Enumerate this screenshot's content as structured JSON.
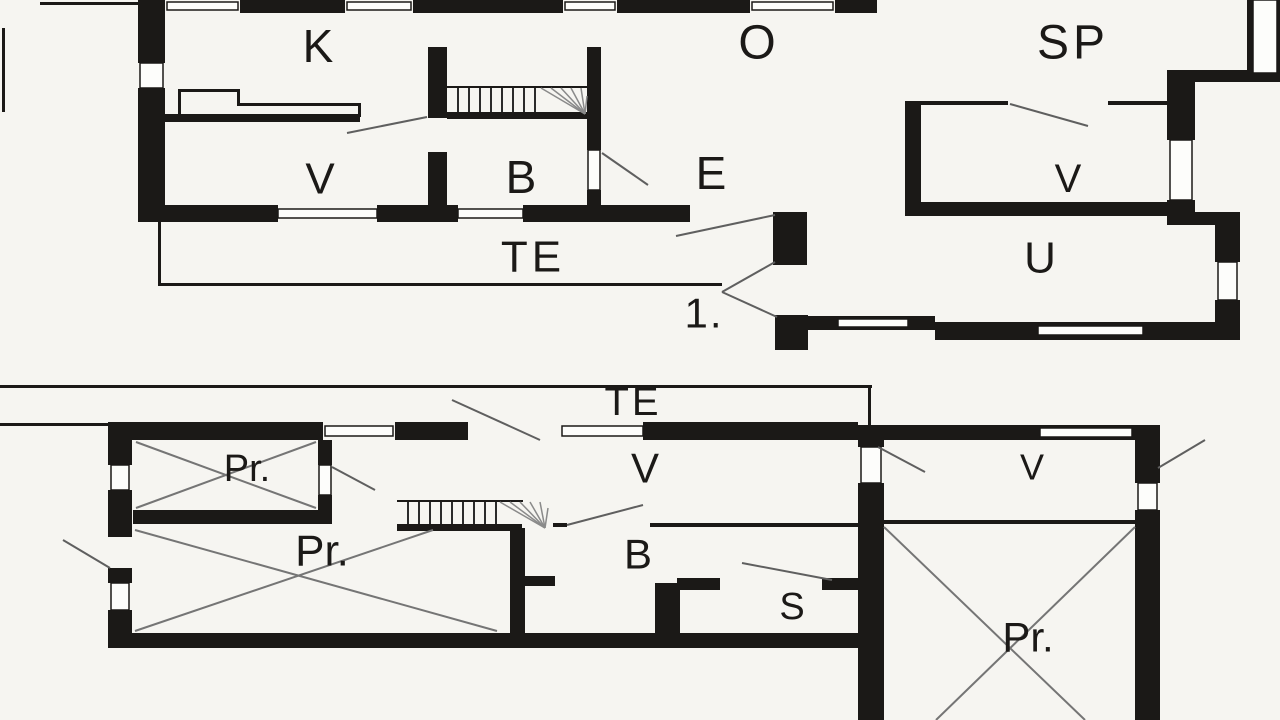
{
  "title": "House floor plans",
  "colors": {
    "background": "#f6f5f1",
    "ink": "#1b1917",
    "door_line": "#5f5f5f",
    "cross_line": "#757575",
    "stair_tread": "#2b2b2b",
    "stair_fan": "#8a8a8a",
    "window_fill": "#fdfdfb"
  },
  "floors": [
    {
      "id": "first-floor",
      "floor_label": "1."
    },
    {
      "id": "ground-floor",
      "floor_label": ""
    }
  ],
  "room_labels": [
    {
      "floor": "first",
      "text": "K",
      "x": 318,
      "y": 46,
      "size": 46,
      "spacing": 0
    },
    {
      "floor": "first",
      "text": "O",
      "x": 757,
      "y": 43,
      "size": 48,
      "spacing": 0
    },
    {
      "floor": "first",
      "text": "SP",
      "x": 1073,
      "y": 43,
      "size": 48,
      "spacing": 4
    },
    {
      "floor": "first",
      "text": "V",
      "x": 320,
      "y": 179,
      "size": 44,
      "spacing": 0
    },
    {
      "floor": "first",
      "text": "B",
      "x": 521,
      "y": 177,
      "size": 46,
      "spacing": 0
    },
    {
      "floor": "first",
      "text": "E",
      "x": 711,
      "y": 173,
      "size": 46,
      "spacing": 0
    },
    {
      "floor": "first",
      "text": "V",
      "x": 1068,
      "y": 179,
      "size": 40,
      "spacing": 0
    },
    {
      "floor": "first",
      "text": "TE",
      "x": 533,
      "y": 257,
      "size": 44,
      "spacing": 4
    },
    {
      "floor": "first",
      "text": "U",
      "x": 1040,
      "y": 258,
      "size": 44,
      "spacing": 0
    },
    {
      "floor": "first",
      "text": "1.",
      "x": 704,
      "y": 313,
      "size": 42,
      "spacing": 2
    },
    {
      "floor": "ground",
      "text": "TE",
      "x": 633,
      "y": 402,
      "size": 40,
      "spacing": 3
    },
    {
      "floor": "ground",
      "text": "Pr.",
      "x": 247,
      "y": 469,
      "size": 38,
      "spacing": 0
    },
    {
      "floor": "ground",
      "text": "V",
      "x": 645,
      "y": 468,
      "size": 42,
      "spacing": 0
    },
    {
      "floor": "ground",
      "text": "V",
      "x": 1032,
      "y": 467,
      "size": 36,
      "spacing": 0
    },
    {
      "floor": "ground",
      "text": "Pr.",
      "x": 322,
      "y": 551,
      "size": 44,
      "spacing": 0
    },
    {
      "floor": "ground",
      "text": "B",
      "x": 638,
      "y": 554,
      "size": 42,
      "spacing": 0
    },
    {
      "floor": "ground",
      "text": "S",
      "x": 792,
      "y": 607,
      "size": 38,
      "spacing": 0
    },
    {
      "floor": "ground",
      "text": "Pr.",
      "x": 1028,
      "y": 637,
      "size": 42,
      "spacing": 0
    }
  ],
  "geometry": {
    "walls": [
      [
        240,
        0,
        105,
        13
      ],
      [
        413,
        0,
        150,
        13
      ],
      [
        617,
        0,
        133,
        13
      ],
      [
        835,
        0,
        42,
        13
      ],
      [
        138,
        0,
        27,
        63
      ],
      [
        138,
        88,
        27,
        132
      ],
      [
        164,
        114,
        196,
        8
      ],
      [
        428,
        47,
        19,
        71
      ],
      [
        428,
        152,
        19,
        70
      ],
      [
        587,
        47,
        14,
        103
      ],
      [
        587,
        190,
        14,
        32
      ],
      [
        138,
        205,
        140,
        17
      ],
      [
        377,
        205,
        81,
        17
      ],
      [
        523,
        205,
        167,
        17
      ],
      [
        773,
        212,
        34,
        53
      ],
      [
        775,
        315,
        33,
        35
      ],
      [
        905,
        103,
        16,
        113
      ],
      [
        905,
        202,
        270,
        14
      ],
      [
        1167,
        70,
        113,
        12
      ],
      [
        1167,
        82,
        28,
        58
      ],
      [
        1167,
        200,
        28,
        25
      ],
      [
        1195,
        212,
        45,
        13
      ],
      [
        1215,
        225,
        25,
        37
      ],
      [
        1215,
        300,
        25,
        30
      ],
      [
        1247,
        0,
        6,
        73
      ],
      [
        1277,
        0,
        3,
        73
      ],
      [
        780,
        316,
        155,
        14
      ],
      [
        935,
        322,
        305,
        18
      ],
      [
        447,
        112,
        143,
        7
      ],
      [
        108,
        422,
        215,
        18
      ],
      [
        395,
        422,
        73,
        18
      ],
      [
        643,
        422,
        215,
        18
      ],
      [
        873,
        425,
        262,
        15
      ],
      [
        1135,
        425,
        25,
        58
      ],
      [
        1135,
        510,
        25,
        210
      ],
      [
        108,
        422,
        24,
        43
      ],
      [
        108,
        490,
        24,
        47
      ],
      [
        108,
        568,
        24,
        15
      ],
      [
        108,
        610,
        24,
        38
      ],
      [
        318,
        440,
        14,
        25
      ],
      [
        318,
        495,
        14,
        29
      ],
      [
        133,
        510,
        199,
        14
      ],
      [
        108,
        633,
        755,
        15
      ],
      [
        510,
        528,
        15,
        120
      ],
      [
        525,
        576,
        30,
        10
      ],
      [
        655,
        583,
        25,
        57
      ],
      [
        677,
        578,
        43,
        12
      ],
      [
        822,
        578,
        48,
        12
      ],
      [
        858,
        425,
        26,
        22
      ],
      [
        858,
        483,
        26,
        237
      ],
      [
        397,
        524,
        125,
        7
      ]
    ],
    "thin": [
      [
        40,
        2,
        98,
        3
      ],
      [
        2,
        28,
        3,
        84
      ],
      [
        158,
        222,
        3,
        64
      ],
      [
        158,
        283,
        564,
        3
      ],
      [
        178,
        89,
        3,
        28
      ],
      [
        178,
        89,
        62,
        3
      ],
      [
        237,
        89,
        3,
        17
      ],
      [
        237,
        103,
        124,
        3
      ],
      [
        358,
        103,
        3,
        14
      ],
      [
        447,
        86,
        143,
        2
      ],
      [
        905,
        101,
        103,
        4
      ],
      [
        1108,
        101,
        67,
        4
      ],
      [
        0,
        385,
        872,
        3
      ],
      [
        0,
        423,
        110,
        3
      ],
      [
        868,
        385,
        3,
        40
      ],
      [
        553,
        523,
        14,
        4
      ],
      [
        650,
        523,
        208,
        4
      ],
      [
        884,
        520,
        251,
        4
      ],
      [
        397,
        500,
        126,
        2
      ]
    ],
    "windows": [
      [
        140,
        63,
        23,
        25
      ],
      [
        588,
        150,
        12,
        40
      ],
      [
        278,
        209,
        99,
        9
      ],
      [
        458,
        209,
        65,
        9
      ],
      [
        1170,
        140,
        22,
        60
      ],
      [
        1218,
        262,
        19,
        38
      ],
      [
        1253,
        0,
        24,
        73
      ],
      [
        838,
        319,
        70,
        8
      ],
      [
        1038,
        326,
        105,
        9
      ],
      [
        167,
        2,
        71,
        8
      ],
      [
        347,
        2,
        64,
        8
      ],
      [
        565,
        2,
        50,
        8
      ],
      [
        752,
        2,
        81,
        8
      ],
      [
        325,
        426,
        68,
        10
      ],
      [
        562,
        426,
        81,
        10
      ],
      [
        1040,
        428,
        92,
        9
      ],
      [
        111,
        465,
        18,
        25
      ],
      [
        111,
        583,
        18,
        27
      ],
      [
        319,
        465,
        12,
        30
      ],
      [
        861,
        447,
        20,
        36
      ],
      [
        1138,
        483,
        19,
        27
      ]
    ],
    "swings": [
      [
        347,
        133,
        427,
        117
      ],
      [
        602,
        153,
        648,
        185
      ],
      [
        676,
        236,
        775,
        215
      ],
      [
        722,
        292,
        775,
        262
      ],
      [
        722,
        292,
        777,
        317
      ],
      [
        1010,
        104,
        1088,
        126
      ],
      [
        452,
        400,
        540,
        440
      ],
      [
        63,
        540,
        110,
        568
      ],
      [
        567,
        525,
        643,
        505
      ],
      [
        742,
        563,
        832,
        580
      ],
      [
        878,
        447,
        925,
        472
      ],
      [
        1158,
        468,
        1205,
        440
      ],
      [
        332,
        467,
        375,
        490
      ]
    ],
    "crosses": [
      [
        136,
        442,
        316,
        508
      ],
      [
        316,
        442,
        136,
        508
      ],
      [
        135,
        530,
        497,
        631
      ],
      [
        433,
        530,
        135,
        631
      ],
      [
        884,
        527,
        1085,
        720
      ],
      [
        1135,
        527,
        936,
        720
      ]
    ],
    "stairs": [
      {
        "name": "upper-stair",
        "treads_x": [
          458,
          469,
          480,
          491,
          502,
          513,
          524,
          535
        ],
        "y1": 88,
        "y2": 112,
        "fan_pivot": [
          585,
          114
        ],
        "fan_tips": [
          [
            541,
            88
          ],
          [
            551,
            88
          ],
          [
            561,
            88
          ],
          [
            571,
            88
          ],
          [
            581,
            88
          ],
          [
            587,
            96
          ]
        ]
      },
      {
        "name": "lower-stair",
        "treads_x": [
          408,
          419,
          430,
          441,
          452,
          463,
          474,
          485,
          496
        ],
        "y1": 502,
        "y2": 524,
        "fan_pivot": [
          545,
          528
        ],
        "fan_tips": [
          [
            500,
            502
          ],
          [
            510,
            502
          ],
          [
            520,
            502
          ],
          [
            530,
            502
          ],
          [
            540,
            502
          ],
          [
            548,
            508
          ]
        ]
      }
    ]
  }
}
